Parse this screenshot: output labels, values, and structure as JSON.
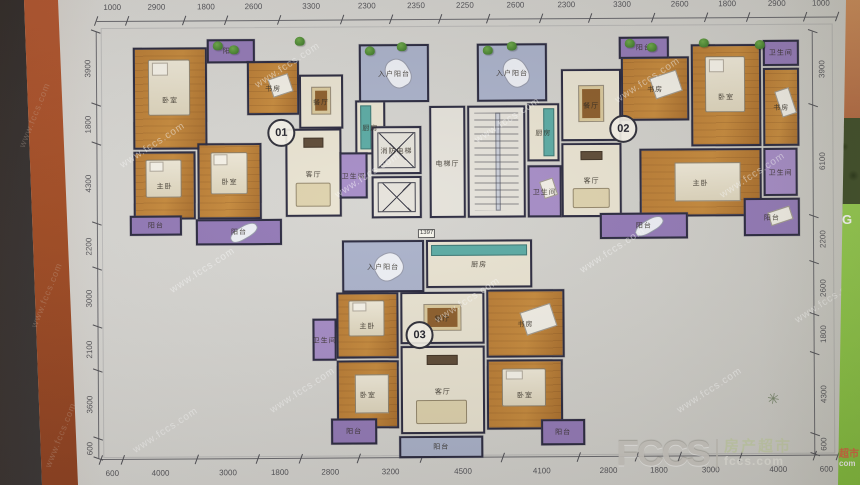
{
  "page": {
    "watermark_text": "www.fccs.com",
    "logo": {
      "wordmark": "FCCS",
      "brand": "房产超市",
      "domain": "fccs.com"
    },
    "corner": {
      "brand": "超市",
      "domain": "com"
    },
    "side_letter": "G",
    "compass_glyph": "✳"
  },
  "colors": {
    "paper": "#d3d2ce",
    "wall": "#26253b",
    "wood_floor": "#b9792f",
    "living_floor": "#e9e3d1",
    "balcony_purple": "#9177b6",
    "balcony_blue": "#a9b1ca",
    "kitchen_teal": "#57a9a2",
    "spine_orange": "#a3491f",
    "side_strip_green": "#8cc63e",
    "logo_gray": "#c8c5bf",
    "brand_green": "#c3cba8"
  },
  "dimensions": {
    "top": [
      "1000",
      "2900",
      "1800",
      "2600",
      "3300",
      "2300",
      "2350",
      "2250",
      "2600",
      "2300",
      "3300",
      "2600",
      "1800",
      "2900",
      "1000"
    ],
    "bottom": [
      "600",
      "4000",
      "3000",
      "1800",
      "2800",
      "3200",
      "4500",
      "4100",
      "2800",
      "1800",
      "3000",
      "4000",
      "600"
    ],
    "left": [
      "3900",
      "1800",
      "4300",
      "2200",
      "3000",
      "2100",
      "3600",
      "600"
    ],
    "right": [
      "3900",
      "6100",
      "2200",
      "2600",
      "1800",
      "4300",
      "600"
    ]
  },
  "floorplan": {
    "inner_note": "1397",
    "units": [
      {
        "id": "01",
        "x": 268,
        "y": 118
      },
      {
        "id": "02",
        "x": 610,
        "y": 116
      },
      {
        "id": "03",
        "x": 405,
        "y": 321
      }
    ],
    "rooms": [
      {
        "name": "bedroom",
        "label": "卧室",
        "t": "wood",
        "furn": "bed",
        "x": 134,
        "y": 46,
        "w": 74,
        "h": 102
      },
      {
        "name": "balcony",
        "label": "阳台",
        "t": "purple",
        "furn": null,
        "x": 208,
        "y": 38,
        "w": 48,
        "h": 24
      },
      {
        "name": "study",
        "label": "书房",
        "t": "wood",
        "furn": "desk",
        "x": 248,
        "y": 60,
        "w": 52,
        "h": 54
      },
      {
        "name": "dining-room",
        "label": "餐厅",
        "t": "cream",
        "furn": "table",
        "x": 300,
        "y": 74,
        "w": 44,
        "h": 54
      },
      {
        "name": "kitchen",
        "label": "厨房",
        "t": "cream",
        "furn": "counterL",
        "x": 356,
        "y": 100,
        "w": 30,
        "h": 54
      },
      {
        "name": "living-room",
        "label": "客厅",
        "t": "cream",
        "furn": "sofa",
        "x": 286,
        "y": 128,
        "w": 56,
        "h": 88
      },
      {
        "name": "master-bedroom",
        "label": "主卧",
        "t": "wood",
        "furn": "bed",
        "x": 134,
        "y": 150,
        "w": 62,
        "h": 68
      },
      {
        "name": "bedroom",
        "label": "卧室",
        "t": "wood",
        "furn": "bed",
        "x": 198,
        "y": 142,
        "w": 64,
        "h": 76
      },
      {
        "name": "bathroom",
        "label": "卫生间",
        "t": "purpleLight",
        "furn": null,
        "x": 340,
        "y": 152,
        "w": 28,
        "h": 46
      },
      {
        "name": "balcony",
        "label": "阳台",
        "t": "purple",
        "furn": "chaise",
        "x": 196,
        "y": 218,
        "w": 86,
        "h": 26
      },
      {
        "name": "balcony",
        "label": "阳台",
        "t": "purple",
        "furn": null,
        "x": 130,
        "y": 214,
        "w": 52,
        "h": 20
      },
      {
        "name": "entry-balcony",
        "label": "入户阳台",
        "t": "blue",
        "furn": "chaise",
        "x": 360,
        "y": 44,
        "w": 70,
        "h": 58
      },
      {
        "name": "entry-balcony",
        "label": "入户阳台",
        "t": "blue",
        "furn": "chaise",
        "x": 478,
        "y": 44,
        "w": 70,
        "h": 58
      },
      {
        "name": "fire-elevator",
        "label": "消防电梯",
        "t": "white",
        "furn": "x",
        "x": 372,
        "y": 126,
        "w": 50,
        "h": 48
      },
      {
        "name": "elevator",
        "label": "",
        "t": "white",
        "furn": "x",
        "x": 372,
        "y": 176,
        "w": 50,
        "h": 42
      },
      {
        "name": "elevator-hall",
        "label": "电梯厅",
        "t": "white",
        "furn": null,
        "x": 430,
        "y": 106,
        "w": 36,
        "h": 112
      },
      {
        "name": "stairwell",
        "label": "",
        "t": "white",
        "furn": "stairs",
        "x": 468,
        "y": 106,
        "w": 58,
        "h": 112
      },
      {
        "name": "kitchen",
        "label": "厨房",
        "t": "cream",
        "furn": "counterR",
        "x": 528,
        "y": 104,
        "w": 32,
        "h": 58
      },
      {
        "name": "bathroom",
        "label": "卫生间",
        "t": "purpleLight",
        "furn": "desk",
        "x": 528,
        "y": 166,
        "w": 34,
        "h": 52
      },
      {
        "name": "dining-room",
        "label": "餐厅",
        "t": "cream",
        "furn": "table",
        "x": 562,
        "y": 70,
        "w": 60,
        "h": 72
      },
      {
        "name": "study",
        "label": "书房",
        "t": "wood",
        "furn": "desk",
        "x": 622,
        "y": 58,
        "w": 68,
        "h": 64
      },
      {
        "name": "balcony",
        "label": "阳台",
        "t": "purple",
        "furn": null,
        "x": 620,
        "y": 38,
        "w": 50,
        "h": 22
      },
      {
        "name": "bedroom",
        "label": "卧室",
        "t": "wood",
        "furn": "bed",
        "x": 692,
        "y": 46,
        "w": 70,
        "h": 102
      },
      {
        "name": "bathroom",
        "label": "卫生间",
        "t": "purple",
        "furn": null,
        "x": 764,
        "y": 42,
        "w": 36,
        "h": 26
      },
      {
        "name": "study",
        "label": "书房",
        "t": "wood",
        "furn": "desk",
        "x": 764,
        "y": 70,
        "w": 36,
        "h": 78
      },
      {
        "name": "living-room",
        "label": "客厅",
        "t": "cream",
        "furn": "sofa",
        "x": 562,
        "y": 144,
        "w": 60,
        "h": 74
      },
      {
        "name": "master-bedroom",
        "label": "主卧",
        "t": "wood",
        "furn": "bedH",
        "x": 640,
        "y": 150,
        "w": 122,
        "h": 68
      },
      {
        "name": "bathroom",
        "label": "卫生间",
        "t": "purpleLight",
        "furn": null,
        "x": 764,
        "y": 150,
        "w": 34,
        "h": 48
      },
      {
        "name": "balcony",
        "label": "阳台",
        "t": "purple",
        "furn": "desk",
        "x": 744,
        "y": 200,
        "w": 56,
        "h": 38
      },
      {
        "name": "balcony",
        "label": "阳台",
        "t": "purple",
        "furn": "chaise",
        "x": 600,
        "y": 214,
        "w": 88,
        "h": 26
      },
      {
        "name": "entry-balcony",
        "label": "入户阳台",
        "t": "blue",
        "furn": "chaise",
        "x": 342,
        "y": 240,
        "w": 82,
        "h": 52
      },
      {
        "name": "kitchen",
        "label": "厨房",
        "t": "cream",
        "furn": "counterT",
        "x": 426,
        "y": 240,
        "w": 106,
        "h": 48
      },
      {
        "name": "dining-room",
        "label": "餐厅",
        "t": "cream",
        "furn": "table",
        "x": 400,
        "y": 292,
        "w": 84,
        "h": 52
      },
      {
        "name": "master-bedroom",
        "label": "主卧",
        "t": "wood",
        "furn": "bed",
        "x": 336,
        "y": 292,
        "w": 62,
        "h": 66
      },
      {
        "name": "bathroom",
        "label": "卫生间",
        "t": "purpleLight",
        "furn": null,
        "x": 312,
        "y": 318,
        "w": 24,
        "h": 42
      },
      {
        "name": "study",
        "label": "书房",
        "t": "wood",
        "furn": "desk",
        "x": 486,
        "y": 290,
        "w": 78,
        "h": 68
      },
      {
        "name": "living-room",
        "label": "客厅",
        "t": "cream",
        "furn": "sofa",
        "x": 400,
        "y": 346,
        "w": 84,
        "h": 88
      },
      {
        "name": "bedroom",
        "label": "卧室",
        "t": "wood",
        "furn": "bedH",
        "x": 336,
        "y": 360,
        "w": 62,
        "h": 68
      },
      {
        "name": "bedroom",
        "label": "卧室",
        "t": "wood",
        "furn": "bed",
        "x": 486,
        "y": 360,
        "w": 76,
        "h": 70
      },
      {
        "name": "balcony",
        "label": "阳台",
        "t": "blue",
        "furn": null,
        "x": 398,
        "y": 436,
        "w": 84,
        "h": 22
      },
      {
        "name": "balcony",
        "label": "阳台",
        "t": "purple",
        "furn": null,
        "x": 330,
        "y": 418,
        "w": 46,
        "h": 26
      },
      {
        "name": "balcony",
        "label": "阳台",
        "t": "purple",
        "furn": null,
        "x": 540,
        "y": 420,
        "w": 44,
        "h": 26
      }
    ],
    "plants": [
      {
        "x": 214,
        "y": 40
      },
      {
        "x": 230,
        "y": 44
      },
      {
        "x": 296,
        "y": 36
      },
      {
        "x": 366,
        "y": 46
      },
      {
        "x": 398,
        "y": 42
      },
      {
        "x": 484,
        "y": 46
      },
      {
        "x": 508,
        "y": 42
      },
      {
        "x": 626,
        "y": 40
      },
      {
        "x": 648,
        "y": 44
      },
      {
        "x": 700,
        "y": 40
      },
      {
        "x": 756,
        "y": 42
      }
    ]
  },
  "watermarks": {
    "plan": [
      {
        "x": 115,
        "y": 140
      },
      {
        "x": 250,
        "y": 60
      },
      {
        "x": 165,
        "y": 265
      },
      {
        "x": 330,
        "y": 170
      },
      {
        "x": 265,
        "y": 385
      },
      {
        "x": 470,
        "y": 115
      },
      {
        "x": 430,
        "y": 295
      },
      {
        "x": 610,
        "y": 75
      },
      {
        "x": 575,
        "y": 245
      },
      {
        "x": 715,
        "y": 170
      },
      {
        "x": 672,
        "y": 385
      },
      {
        "x": 790,
        "y": 295
      },
      {
        "x": 128,
        "y": 425
      }
    ],
    "strip": [
      {
        "x": 0,
        "y": 110
      },
      {
        "x": 12,
        "y": 290
      },
      {
        "x": 26,
        "y": 430
      }
    ]
  }
}
